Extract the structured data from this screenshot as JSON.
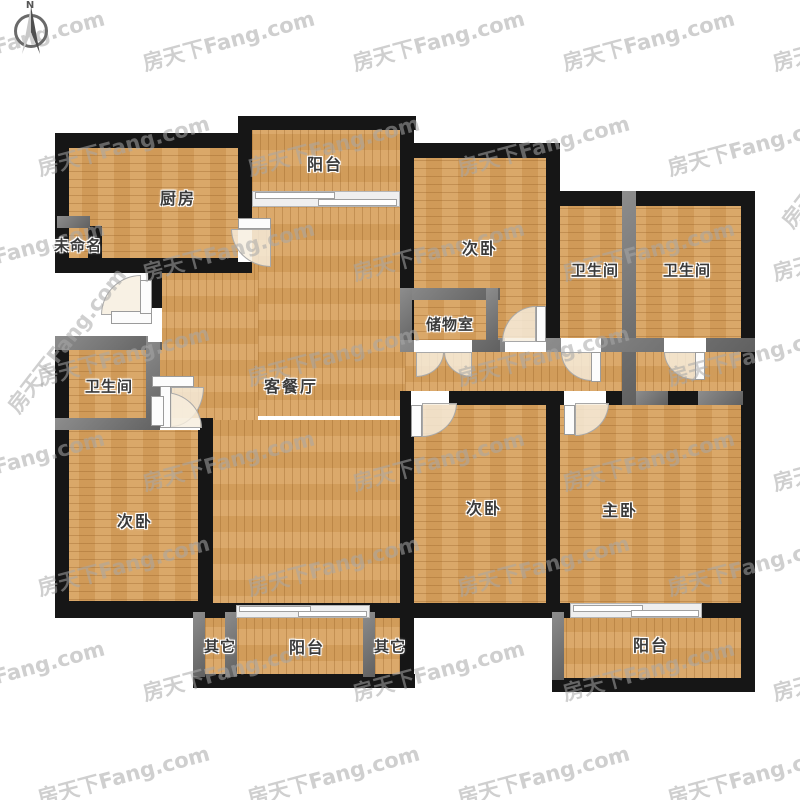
{
  "compass": {
    "north_label": "N"
  },
  "watermark": {
    "text": "房天下Fang.com"
  },
  "colors": {
    "wall": "#161616",
    "partition_wall": "#6f6f6f",
    "floor_wood": "#d7a15e",
    "door_fill": "#f6eede",
    "label_text": "#3a3a3a",
    "watermark_text": "#a8a8a8",
    "background": "#ffffff"
  },
  "rooms": [
    {
      "id": "kitchen",
      "label": "厨房"
    },
    {
      "id": "unnamed-nook",
      "label": "未命名"
    },
    {
      "id": "balcony-top",
      "label": "阳台"
    },
    {
      "id": "bedroom-top",
      "label": "次卧"
    },
    {
      "id": "bathroom-ensuite-left",
      "label": "卫生间"
    },
    {
      "id": "bathroom-ensuite-right",
      "label": "卫生间"
    },
    {
      "id": "storage-room",
      "label": "储物室"
    },
    {
      "id": "living-dining-room",
      "label": "客餐厅"
    },
    {
      "id": "bathroom-left",
      "label": "卫生间"
    },
    {
      "id": "bedroom-left",
      "label": "次卧"
    },
    {
      "id": "bedroom-middle",
      "label": "次卧"
    },
    {
      "id": "master-bedroom",
      "label": "主卧"
    },
    {
      "id": "other-left",
      "label": "其它"
    },
    {
      "id": "balcony-bottom",
      "label": "阳台"
    },
    {
      "id": "other-right",
      "label": "其它"
    },
    {
      "id": "balcony-right",
      "label": "阳台"
    }
  ]
}
